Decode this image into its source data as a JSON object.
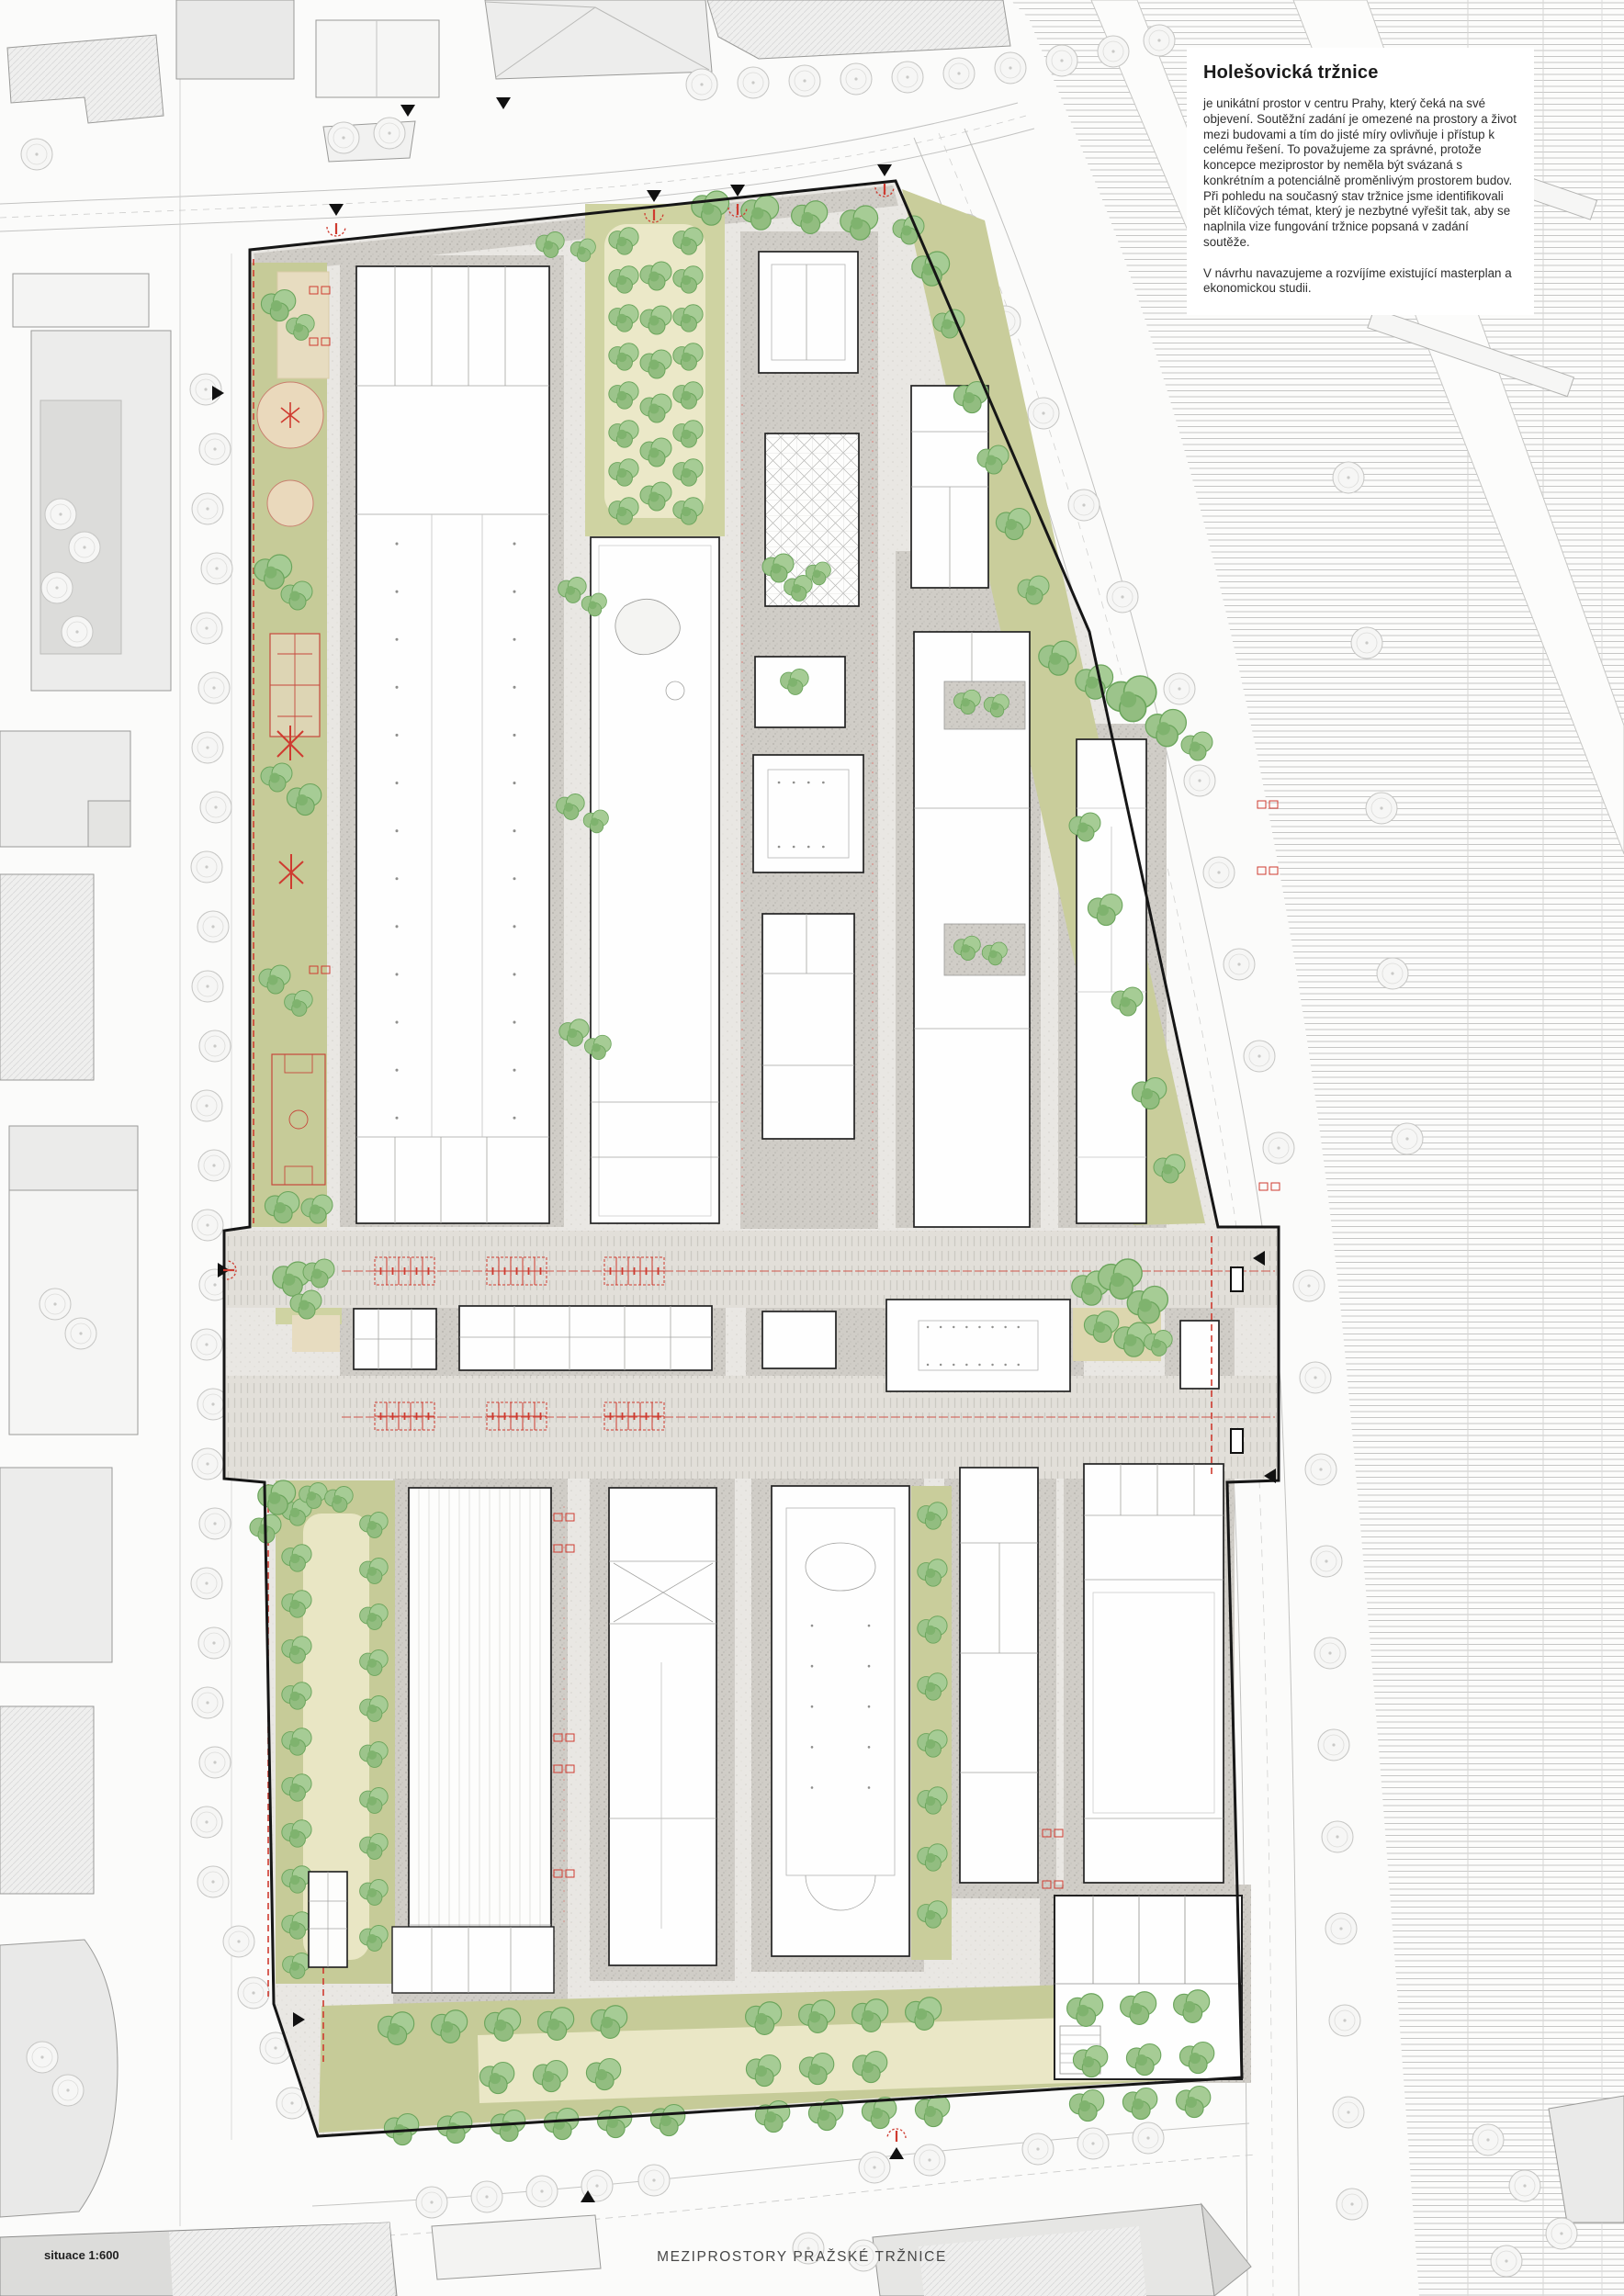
{
  "title_block": {
    "title": "Holešovická tržnice",
    "paragraph_1": "je unikátní prostor v centru Prahy, který čeká na své objevení. Soutěžní zadání je omezené na prostory a život mezi budovami a tím do jisté míry ovlivňuje i přístup k celému řešení. To považujeme za správné, protože koncepce meziprostor by neměla být svázaná s konkrétním a potenciálně proměnlivým prostorem budov. Při pohledu na současný stav tržnice jsme identifikovali pět klíčových témat, který je nezbytné vyřešit tak, aby se naplnila vize fungování tržnice popsaná v zadání soutěže.",
    "paragraph_2": "V návrhu navazujeme a rozvíjíme existující masterplan a ekonomickou studii."
  },
  "footer": {
    "scale_label": "situace 1:600",
    "drawing_title": "MEZIPROSTORY PRAŽSKÉ TRŽNICE"
  },
  "plan": {
    "site_name": "Holešovická tržnice",
    "drawing_type": "site plan (situace)",
    "features": [
      "market-halls",
      "central-boulevard-with-stalls",
      "tree-lined-lawns",
      "playgrounds-and-courts",
      "railway-yard-context",
      "entrance-markers"
    ],
    "colors": {
      "accent_red": "#cf3b30",
      "tree_green": "#8fbf7f",
      "lawn_olive": "#c6cb98",
      "pale_lawn": "#eae7c6",
      "paving": "#e8e6e2",
      "gravel": "#cfccc6",
      "boundary_black": "#161616",
      "context_gray": "#ececeb",
      "hatch_gray": "#c0c0bf"
    }
  }
}
